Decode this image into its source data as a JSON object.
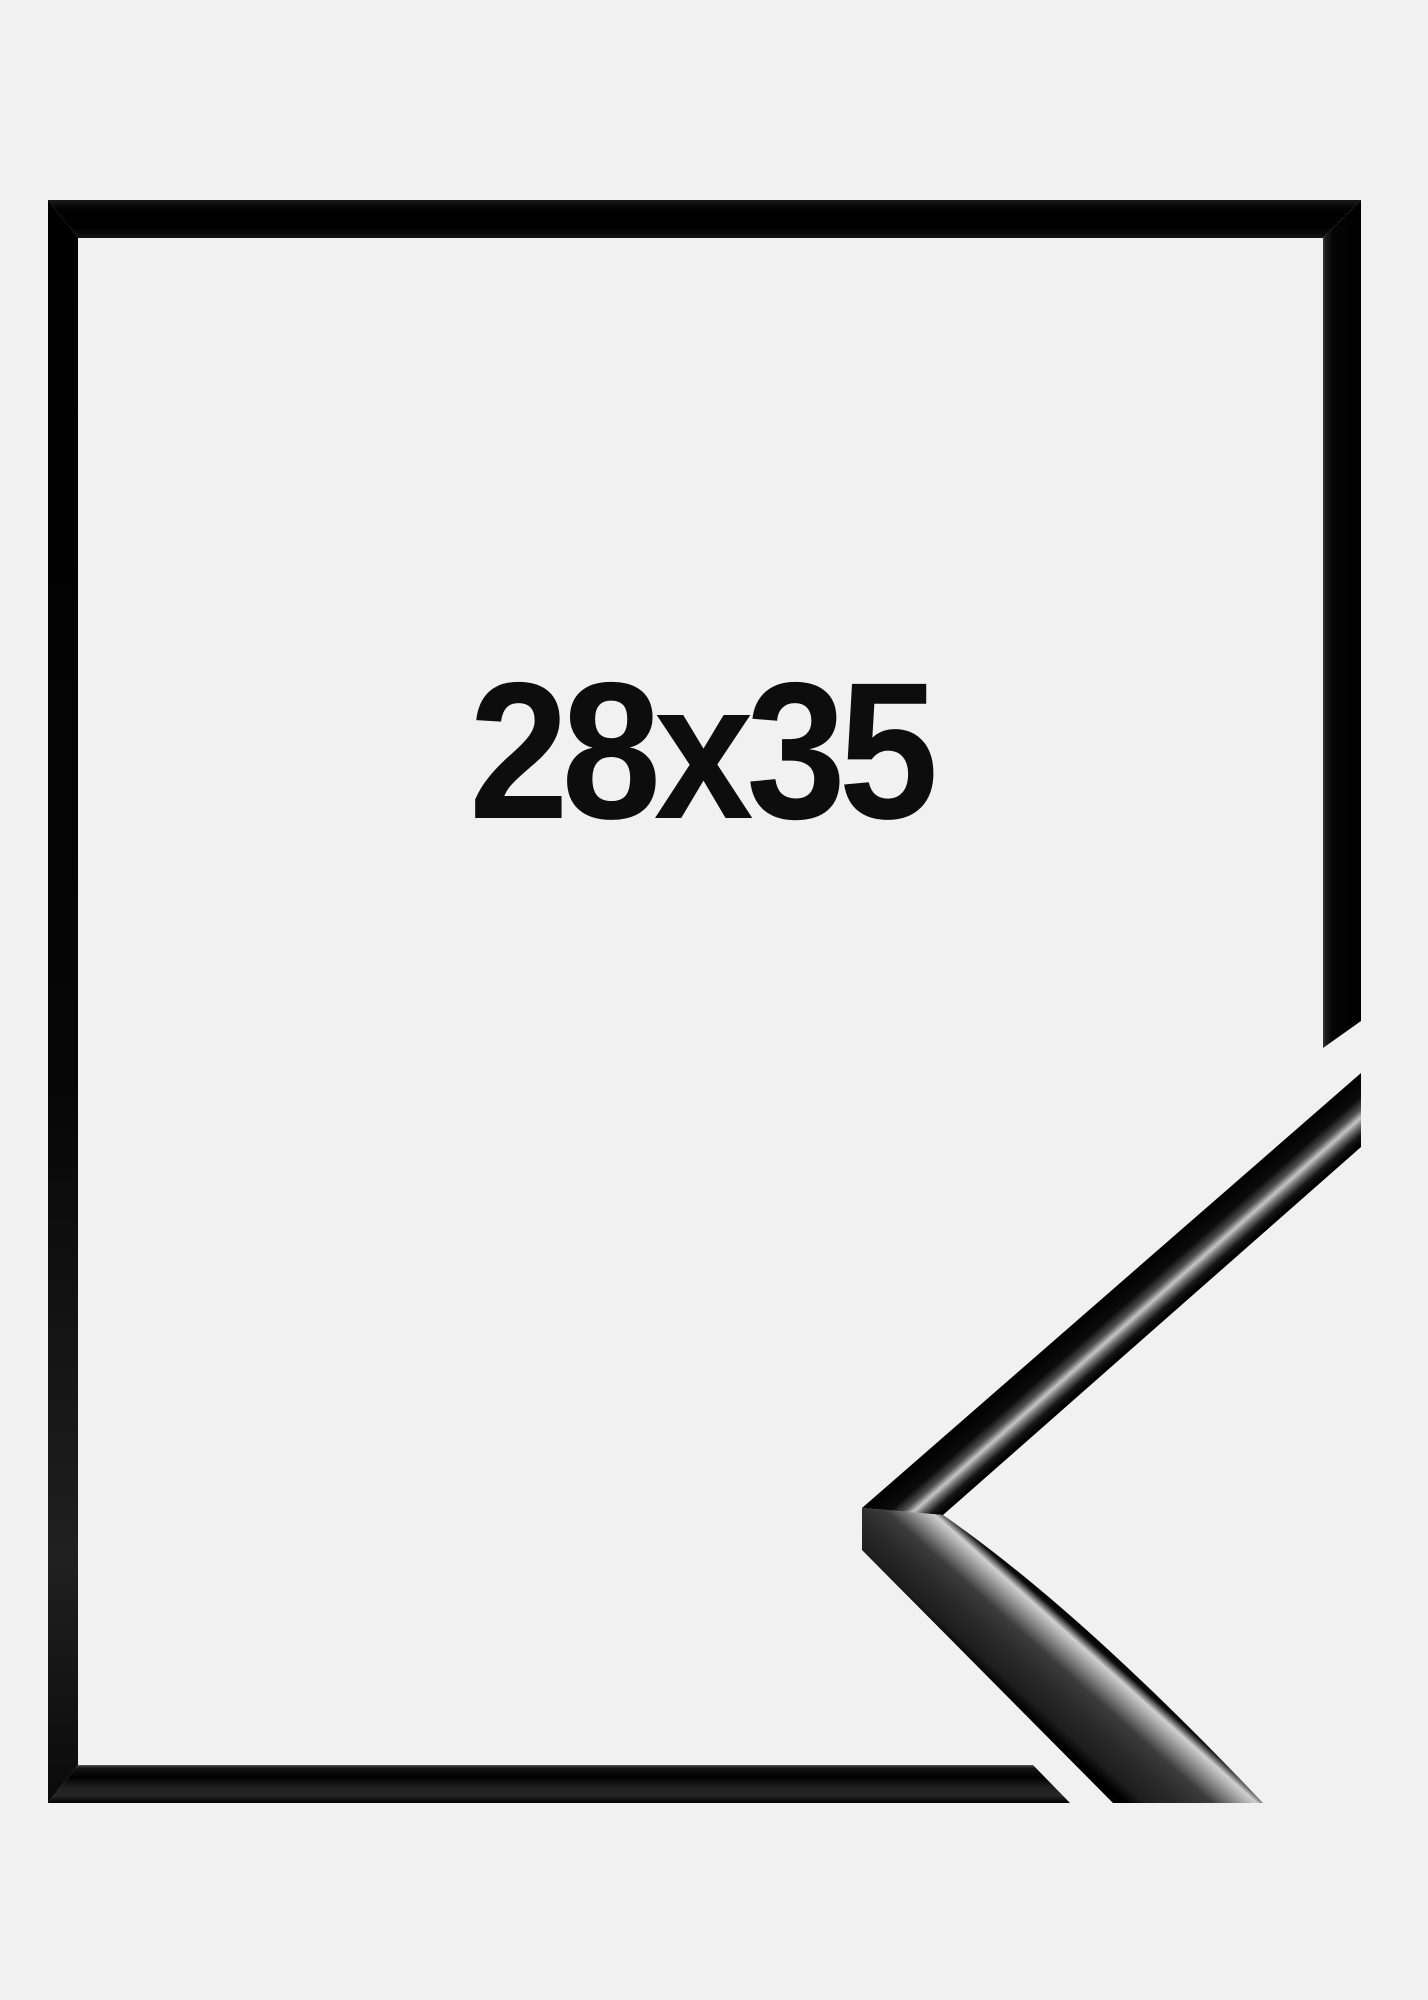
{
  "product": {
    "size_label": "28x35"
  },
  "colors": {
    "background": "#f1f1f2",
    "frame_black": "#000000",
    "label_text": "#0d0d0d",
    "metallic_highlight": "#c6c6c6"
  }
}
